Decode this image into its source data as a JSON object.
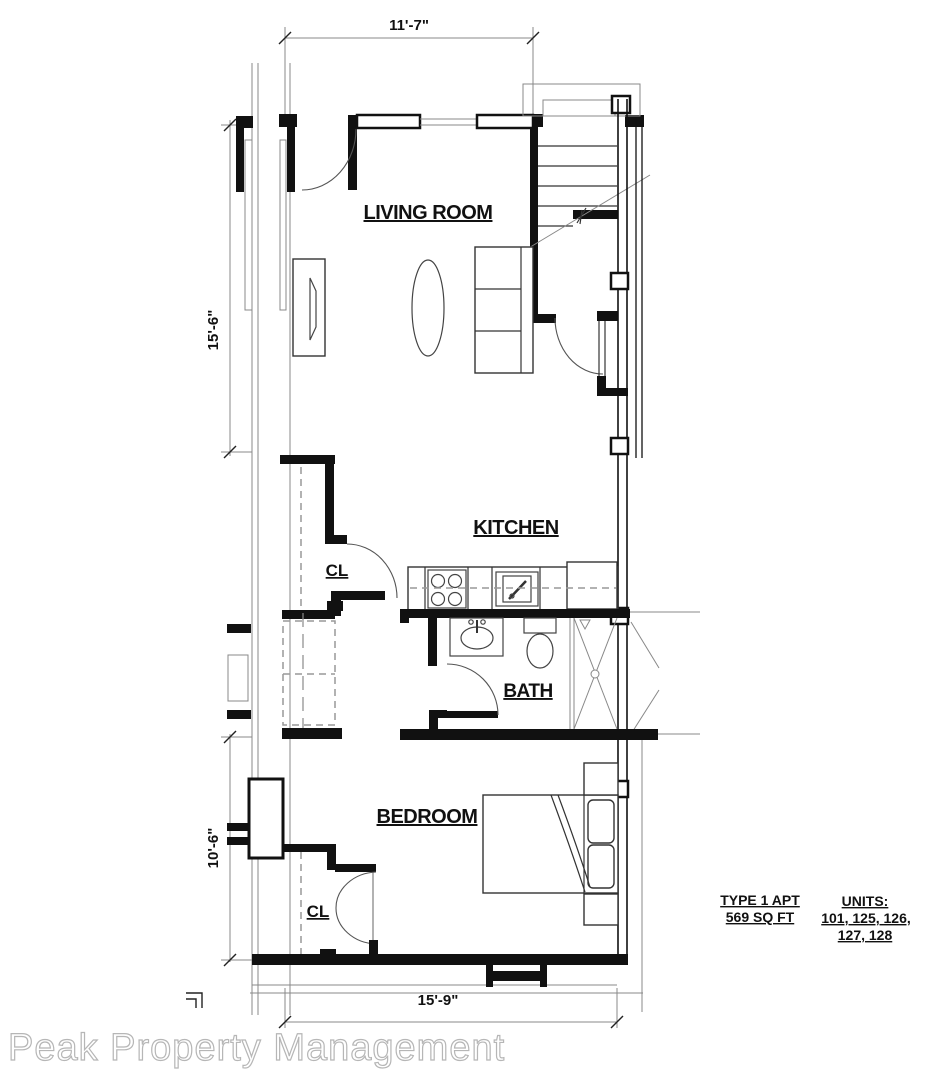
{
  "rooms": {
    "living_room": "LIVING ROOM",
    "kitchen": "KITCHEN",
    "bath": "BATH",
    "bedroom": "BEDROOM",
    "closet_upper": "CL",
    "closet_lower": "CL"
  },
  "dimensions": {
    "top": "11'-7\"",
    "left_upper": "15'-6\"",
    "left_lower": "10'-6\"",
    "bottom": "15'-9\""
  },
  "info": {
    "apt_type": "TYPE 1 APT",
    "apt_area": "569 SQ FT",
    "units_label": "UNITS:",
    "units_line1": "101, 125, 126,",
    "units_line2": "127, 128"
  },
  "watermark": "Peak Property Management",
  "colors": {
    "wall": "#111111",
    "thin_line": "#333333",
    "dimension_line": "#888888",
    "dashed_line": "#999999",
    "watermark_stroke": "#b6b6b6",
    "background": "#ffffff"
  }
}
